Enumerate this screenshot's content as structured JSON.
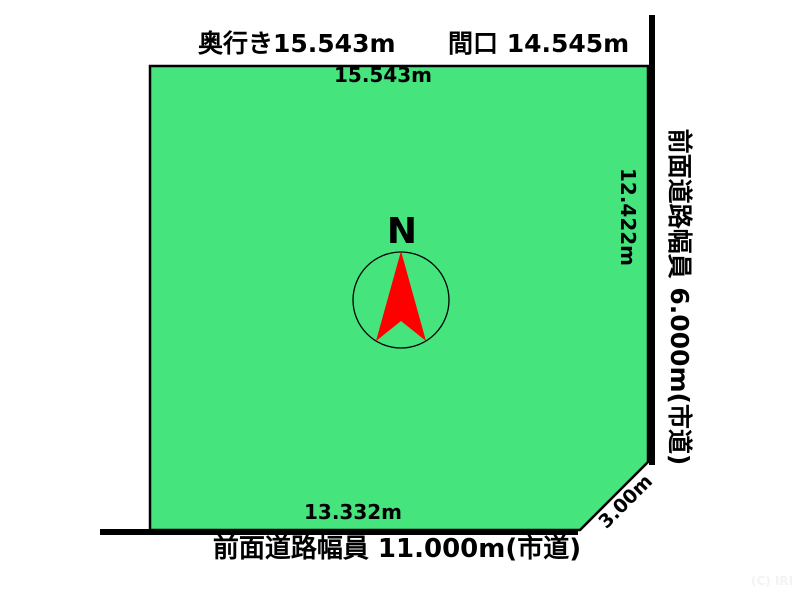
{
  "diagram": {
    "header": {
      "depth_label": "奥行き15.543m",
      "frontage_label": "間口 14.545m"
    },
    "plot": {
      "top_dim": "15.543m",
      "right_dim": "12.422m",
      "bottom_dim": "13.332m",
      "corner_dim": "3.00m"
    },
    "roads": {
      "right_label": "前面道路幅員 6.000m(市道)",
      "bottom_label": "前面道路幅員 11.000m(市道)"
    },
    "compass": {
      "north_label": "N"
    },
    "watermark": "(C) IRI",
    "colors": {
      "plot_fill": "#46e47d",
      "outline": "#000000",
      "arrow": "#ff0000",
      "watermark_text": "#f3f3f3"
    }
  }
}
